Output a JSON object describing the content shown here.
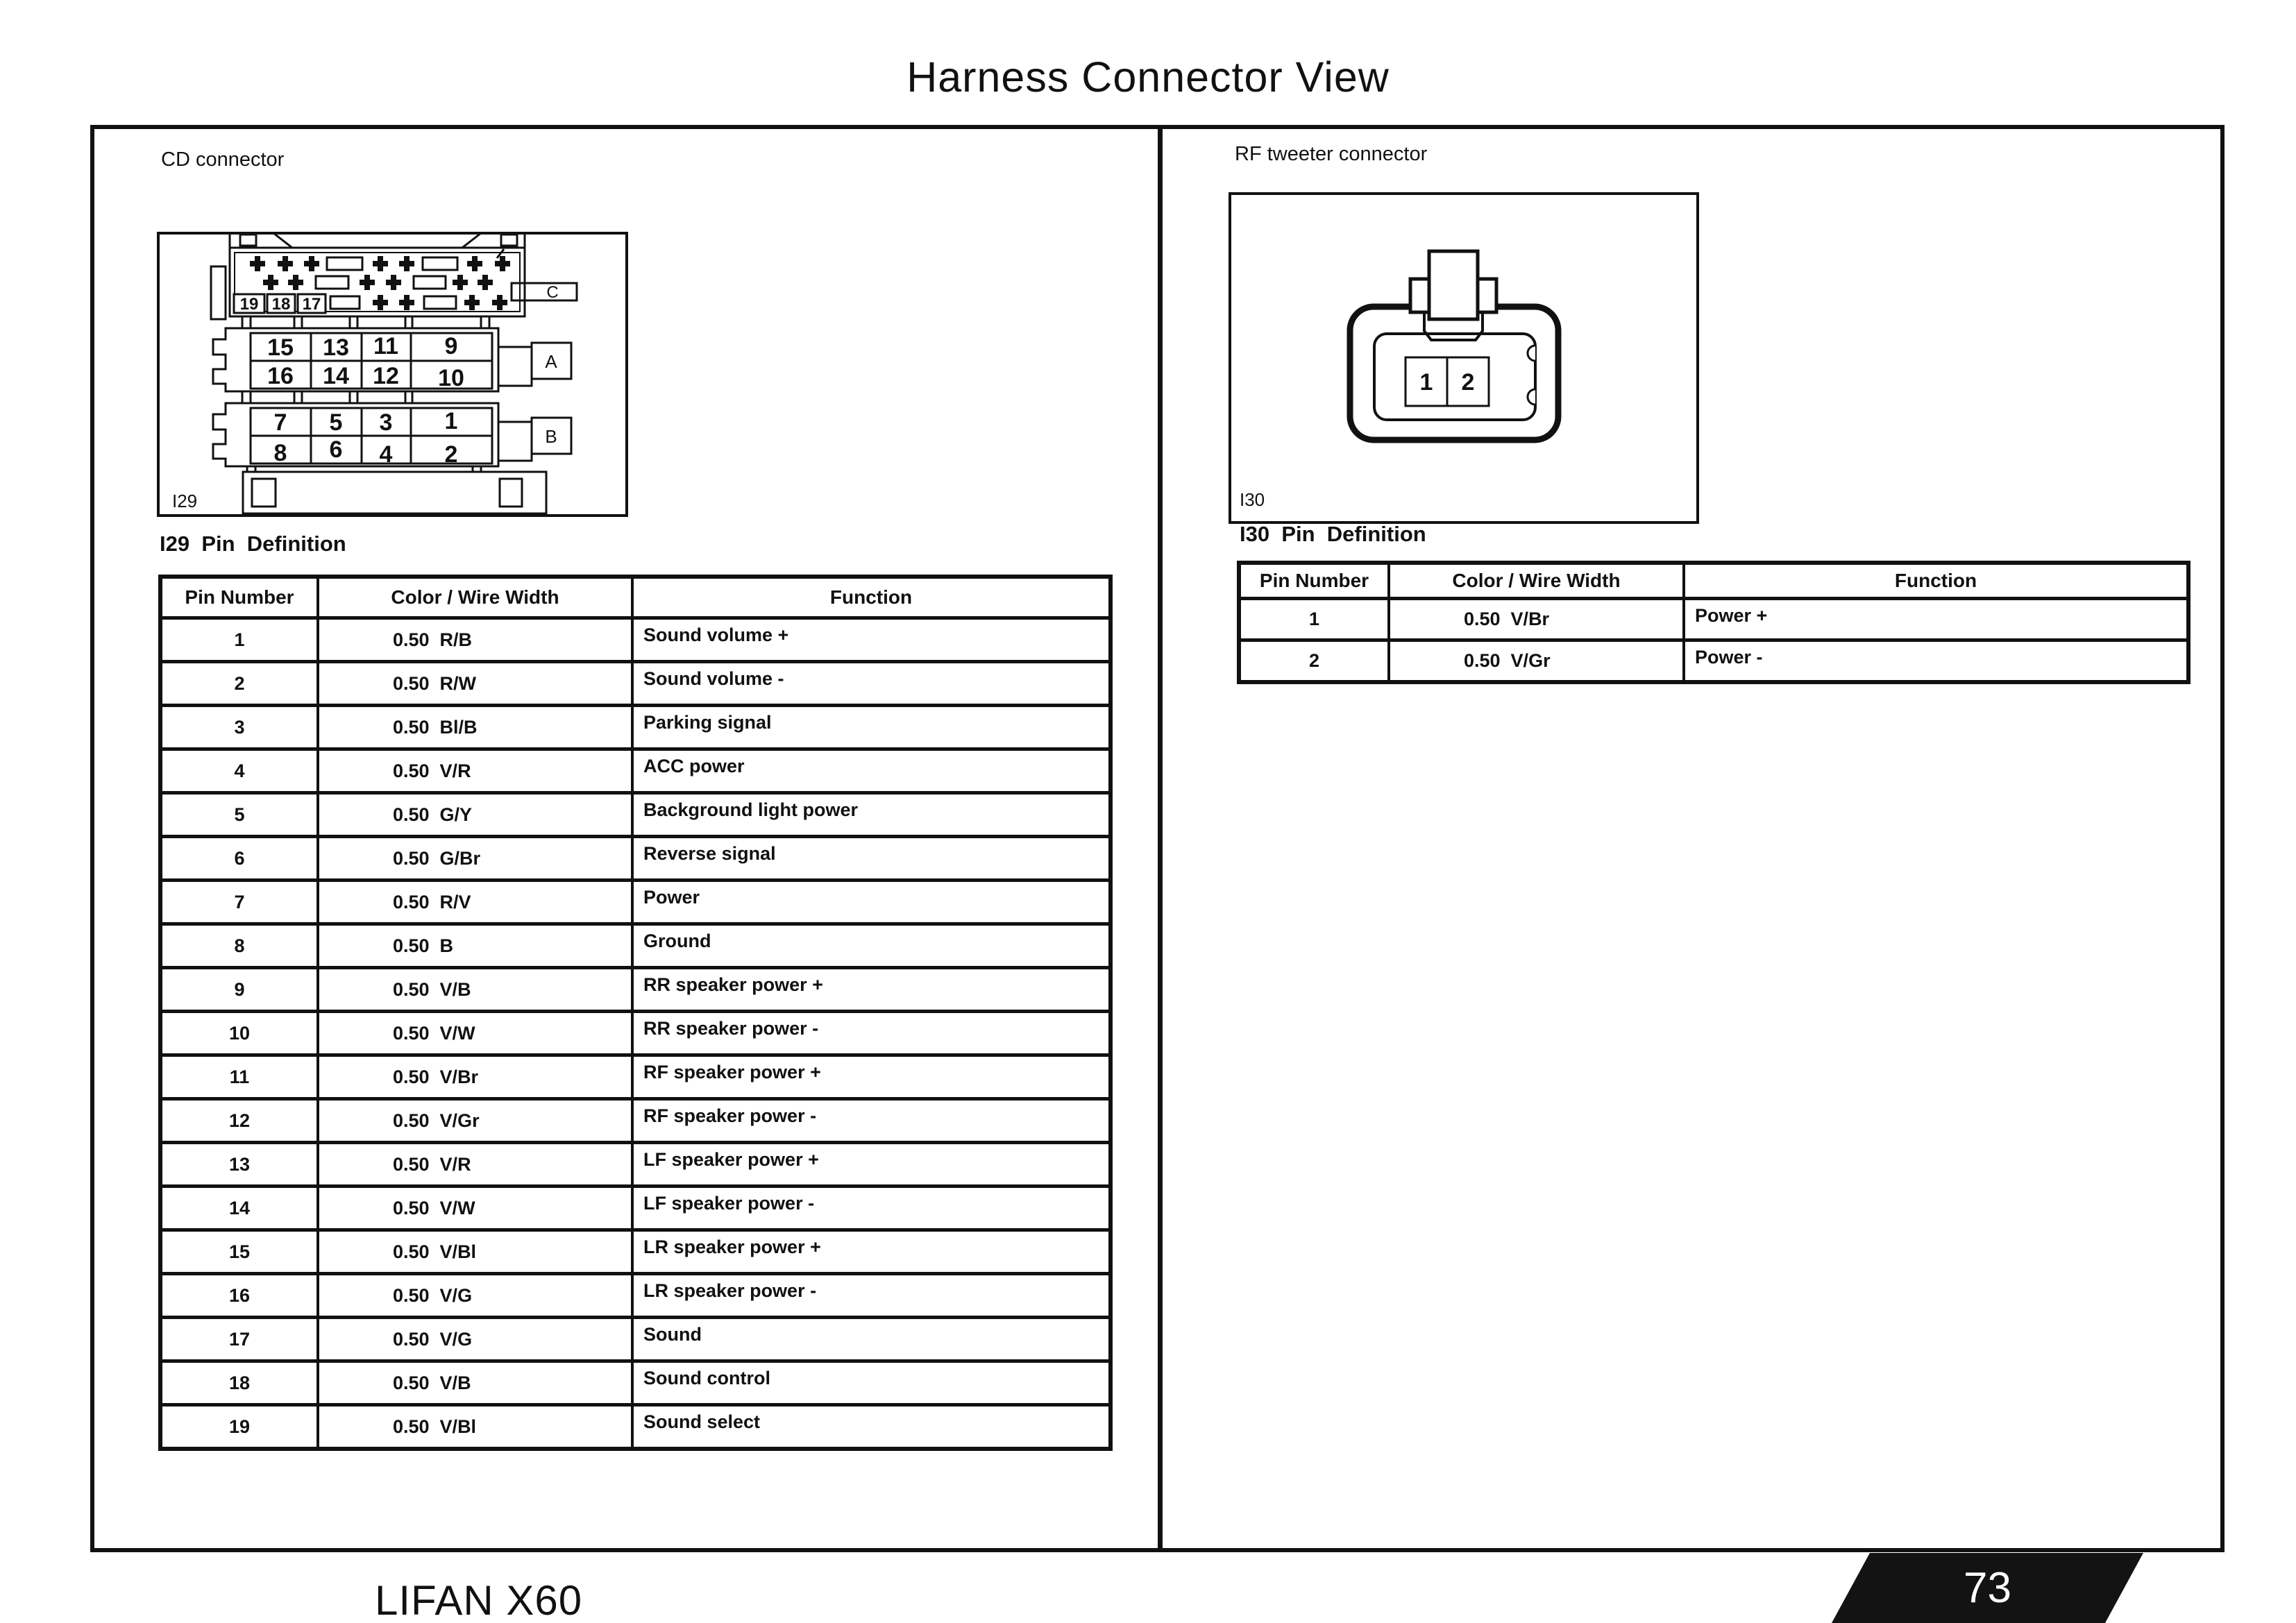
{
  "page": {
    "title": "Harness Connector View",
    "footer_model": "LIFAN X60",
    "page_number": "73"
  },
  "cd": {
    "label": "CD connector",
    "connector_id": "I29",
    "rear_pins": [
      "19",
      "18",
      "17"
    ],
    "tab_a": "A",
    "tab_b": "B",
    "tab_c": "C",
    "grid_a": [
      [
        "15",
        "13",
        "11",
        "9"
      ],
      [
        "16",
        "14",
        "12",
        "10"
      ]
    ],
    "grid_b": [
      [
        "7",
        "5",
        "3",
        "1"
      ],
      [
        "8",
        "6",
        "4",
        "2"
      ]
    ],
    "heading": "I29  Pin  Definition",
    "table": {
      "headers": [
        "Pin Number",
        "Color / Wire Width",
        "Function"
      ],
      "rows": [
        [
          "1",
          "0.50  R/B",
          "Sound volume +"
        ],
        [
          "2",
          "0.50  R/W",
          "Sound volume -"
        ],
        [
          "3",
          "0.50  Bl/B",
          "Parking signal"
        ],
        [
          "4",
          "0.50  V/R",
          "ACC power"
        ],
        [
          "5",
          "0.50  G/Y",
          "Background light power"
        ],
        [
          "6",
          "0.50  G/Br",
          "Reverse signal"
        ],
        [
          "7",
          "0.50  R/V",
          "Power"
        ],
        [
          "8",
          "0.50  B",
          "Ground"
        ],
        [
          "9",
          "0.50  V/B",
          "RR speaker power +"
        ],
        [
          "10",
          "0.50  V/W",
          "RR speaker power -"
        ],
        [
          "11",
          "0.50  V/Br",
          "RF speaker power +"
        ],
        [
          "12",
          "0.50  V/Gr",
          "RF speaker power -"
        ],
        [
          "13",
          "0.50  V/R",
          "LF speaker power +"
        ],
        [
          "14",
          "0.50  V/W",
          "LF speaker power -"
        ],
        [
          "15",
          "0.50  V/Bl",
          "LR speaker power +"
        ],
        [
          "16",
          "0.50  V/G",
          "LR speaker power -"
        ],
        [
          "17",
          "0.50  V/G",
          "Sound"
        ],
        [
          "18",
          "0.50  V/B",
          "Sound control"
        ],
        [
          "19",
          "0.50  V/Bl",
          "Sound select"
        ]
      ]
    }
  },
  "rf": {
    "label": "RF tweeter connector",
    "connector_id": "I30",
    "pins": [
      "1",
      "2"
    ],
    "heading": "I30  Pin  Definition",
    "table": {
      "headers": [
        "Pin Number",
        "Color / Wire Width",
        "Function"
      ],
      "rows": [
        [
          "1",
          "0.50  V/Br",
          "Power +"
        ],
        [
          "2",
          "0.50  V/Gr",
          "Power -"
        ]
      ]
    }
  }
}
